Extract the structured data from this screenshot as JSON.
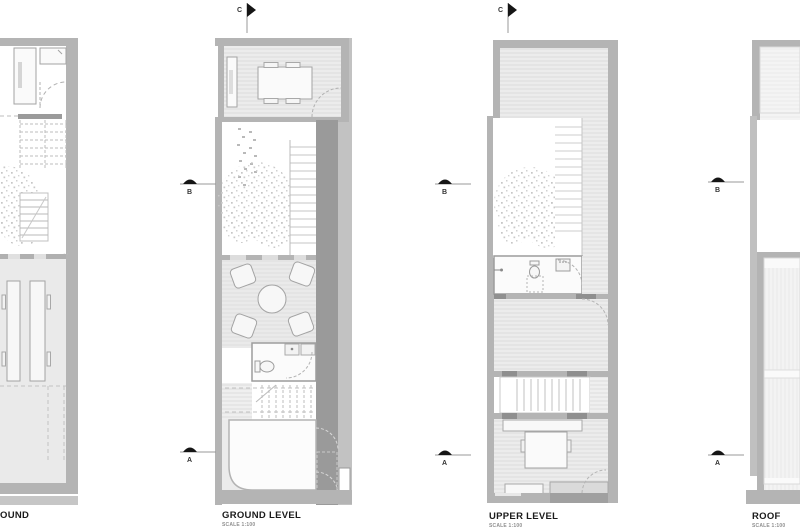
{
  "canvas": {
    "width": 800,
    "height": 530
  },
  "plans": [
    {
      "label": "OUND",
      "scale": ""
    },
    {
      "label": "GROUND LEVEL",
      "scale": "SCALE 1:100"
    },
    {
      "label": "UPPER LEVEL",
      "scale": "SCALE 1:100"
    },
    {
      "label": "ROOF",
      "scale": "SCALE 1:100"
    }
  ],
  "markers": {
    "section_a": "A",
    "section_b": "B",
    "section_c": "C"
  },
  "colors": {
    "wall": "#b4b4b4",
    "wall_dark": "#9a9a9a",
    "floor": "#ececec",
    "hatch_line": "#dddddd",
    "furniture_line": "#a3a3a3",
    "stipple": "#c7c7c7",
    "marker_fill": "#151515",
    "label_text": "#1a1a1a",
    "scale_text": "#8f8f8f"
  }
}
